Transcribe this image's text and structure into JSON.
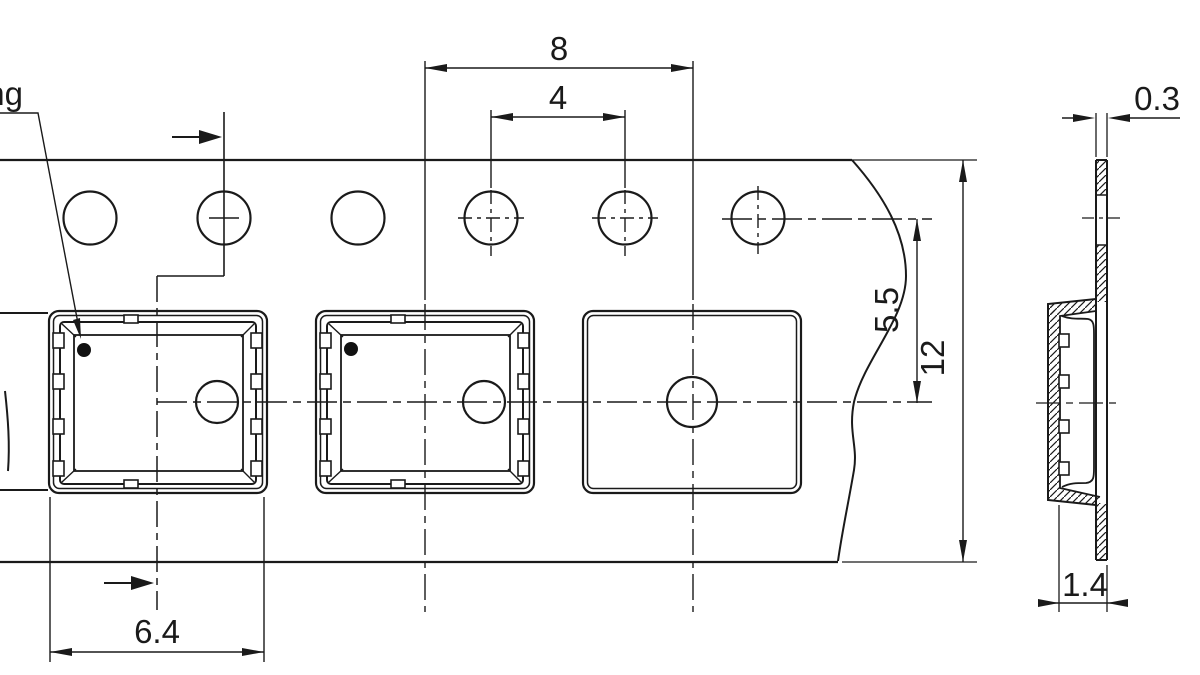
{
  "drawing": {
    "type": "carrier-tape-technical-drawing",
    "callout": {
      "visible_text": "ng"
    },
    "dimensions": {
      "pocket_pitch": "8",
      "sprocket_hole_pitch": "4",
      "hole_center_to_pocket_center": "5.5",
      "tape_width": "12",
      "pocket_width": "6.4",
      "tape_thickness": "0.3",
      "pocket_depth": "1.4"
    },
    "colors": {
      "line": "#1a1a1a",
      "background": "#ffffff",
      "marking_dot": "#111111"
    }
  }
}
